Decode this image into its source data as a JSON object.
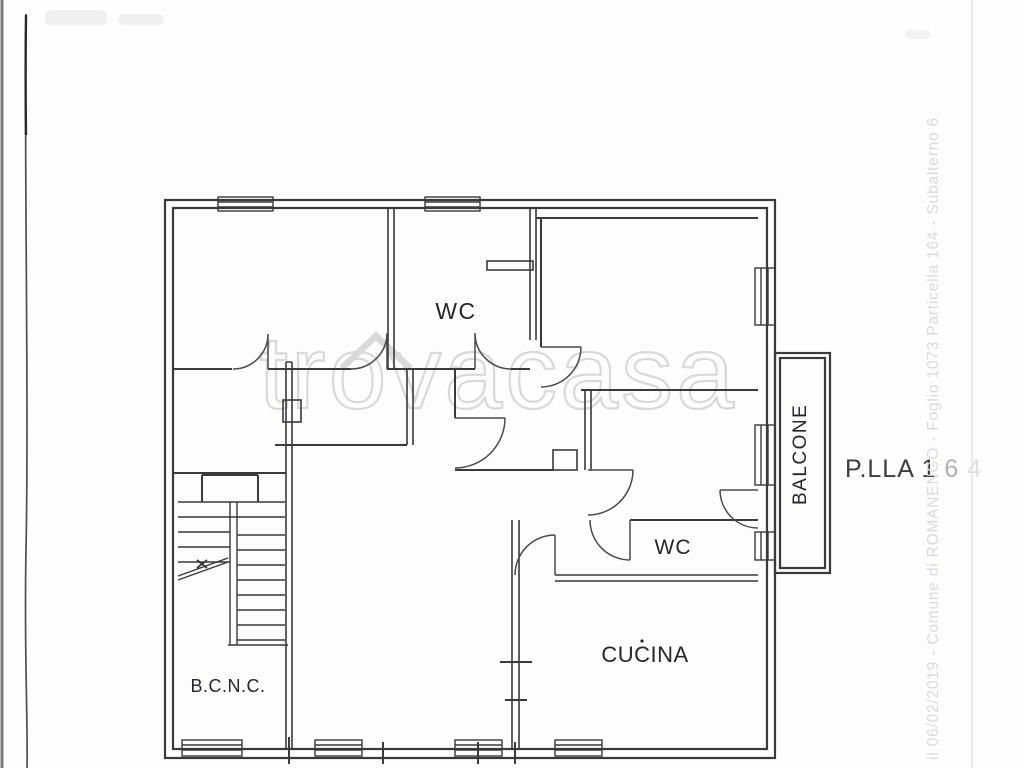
{
  "colors": {
    "paper": "#fdfdfb",
    "wall": "#3a3a3c",
    "door": "#4a4a4c",
    "label": "#26262a",
    "parcel": "#3a3d42",
    "watermark": "#d9d9d9",
    "faint_text": "#d9dadf",
    "fold_line": "#4f4f4f",
    "page_edge": "#7a7a7a"
  },
  "watermark": {
    "text": "trovacasa"
  },
  "labels": {
    "wc_top": "WC",
    "wc_bottom": "WC",
    "cucina": "CUCINA",
    "bcnc": "B.C.N.C.",
    "balcone": "BALCONE"
  },
  "parcel": {
    "main": "P.LLA 1",
    "mid": "6",
    "faint": "4"
  },
  "scan": {
    "side_text": "il 06/02/2019 - Comune di ROMANENGO - Foglio 1073 Particella 164 - Subalterno 6"
  }
}
